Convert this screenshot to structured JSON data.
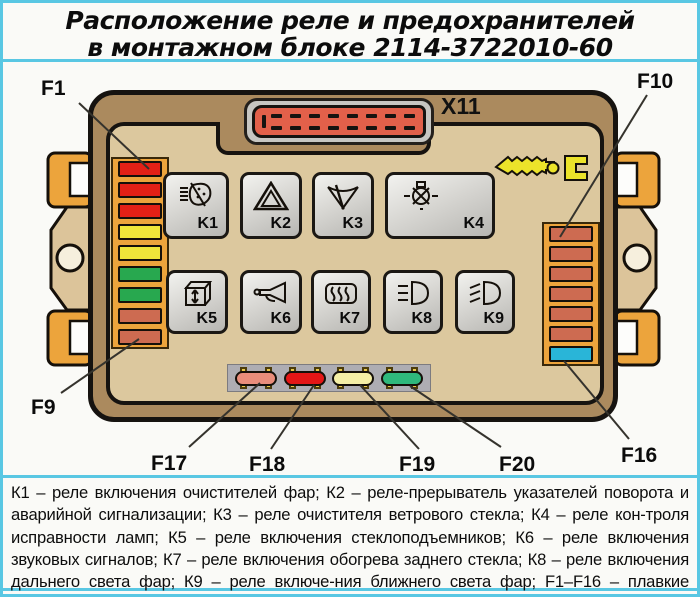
{
  "title": {
    "line1": "Расположение реле и предохранителей",
    "line2": "в монтажном блоке 2114-3722010-60"
  },
  "block": {
    "connector_label": "X11"
  },
  "callouts": {
    "f1": "F1",
    "f9": "F9",
    "f10": "F10",
    "f16": "F16",
    "f17": "F17",
    "f18": "F18",
    "f19": "F19",
    "f20": "F20"
  },
  "relays": [
    {
      "id": "K1",
      "icon": "headlamp-washer-icon"
    },
    {
      "id": "K2",
      "icon": "hazard-warning-icon"
    },
    {
      "id": "K3",
      "icon": "windscreen-wiper-icon"
    },
    {
      "id": "K4",
      "icon": "lamp-check-icon"
    },
    {
      "id": "K5",
      "icon": "window-lifter-icon"
    },
    {
      "id": "K6",
      "icon": "horn-icon"
    },
    {
      "id": "K7",
      "icon": "heated-rear-window-icon"
    },
    {
      "id": "K8",
      "icon": "high-beam-icon"
    },
    {
      "id": "K9",
      "icon": "low-beam-icon"
    }
  ],
  "left_fuses": [
    "red",
    "red",
    "red",
    "yellow",
    "yellow",
    "green",
    "green",
    "salmon",
    "salmon"
  ],
  "right_fuses": [
    "salmon",
    "salmon",
    "salmon",
    "salmon",
    "salmon",
    "salmon",
    "cyan"
  ],
  "spare_fuses": [
    "spare_salmon",
    "spare_red",
    "spare_yellow",
    "spare_green"
  ],
  "colors": {
    "red": "#e32016",
    "yellow": "#efe63a",
    "green": "#28a84f",
    "salmon": "#cd6b51",
    "cyan": "#29b5d8",
    "spare_salmon": "#e98d7b",
    "spare_red": "#e41616",
    "spare_yellow": "#f5efa6",
    "spare_green": "#2fb87c",
    "frame_cyan": "#59c7e3",
    "block_brown": "#ab8a5e",
    "panel_tan": "#dcc89e",
    "holder_orange": "#eca43c",
    "connector_red": "#e2604a"
  },
  "legend": {
    "text": "К1 – реле включения очистителей фар; К2 – реле-прерыватель указателей поворота и аварийной сигнализации; К3 – реле очистителя ветрового стекла; К4 – реле кон-троля исправности ламп; К5 – реле включения стеклоподъемников; К6 – реле включения звуковых сигналов; К7 – реле включения обогрева заднего стекла; К8 – реле включения дальнего света фар; К9 – реле включе-ния ближнего света фар; F1–F16 – плавкие предохранители; F17–F20 – запасные предохранители"
  }
}
